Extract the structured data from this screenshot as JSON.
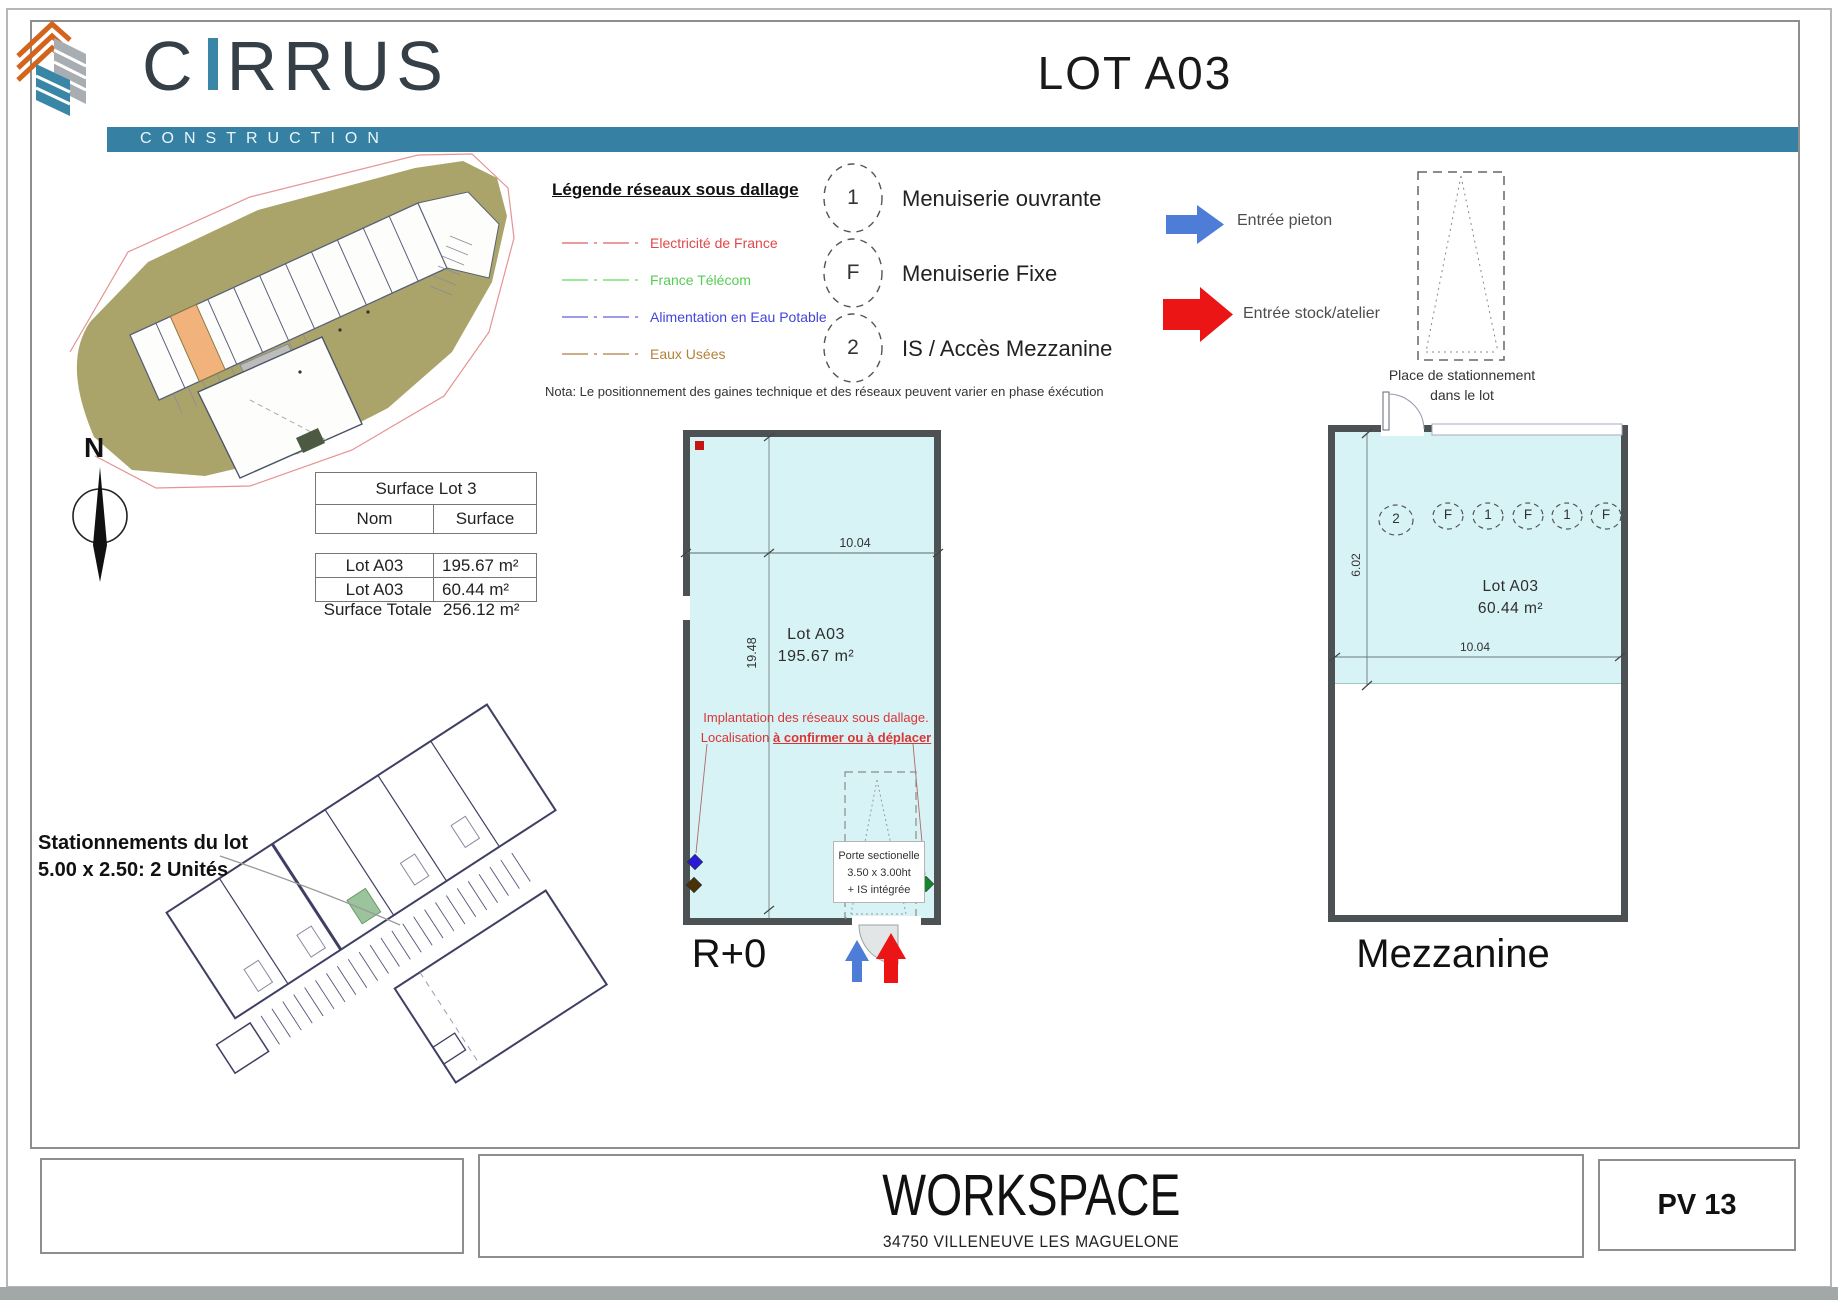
{
  "header": {
    "brand": "CIRRUS",
    "brand_tagline": "CONSTRUCTION",
    "sheet_title": "LOT A03"
  },
  "colors": {
    "brand_teal": "#3580a3",
    "plan_fill": "#d8f3f6",
    "wall_grey": "#4c5254",
    "entry_blue": "#4d7dd6",
    "entry_red": "#ec1515",
    "site_olive": "#aaa46b",
    "highlight_orange": "#f2b27c",
    "warning_red": "#d93535"
  },
  "site_plan": {
    "north_label": "N"
  },
  "legend_networks": {
    "title": "Légende réseaux sous dallage",
    "items": [
      {
        "label": "Electricité de France",
        "color": "#e04848"
      },
      {
        "label": "France Télécom",
        "color": "#55cc55"
      },
      {
        "label": "Alimentation en Eau Potable",
        "color": "#4444dd"
      },
      {
        "label": "Eaux Usées",
        "color": "#b5823c"
      }
    ],
    "nota": "Nota: Le positionnement des gaines technique et des réseaux peuvent varier en phase éxécution"
  },
  "legend_openings": {
    "items": [
      {
        "symbol": "1",
        "label": "Menuiserie ouvrante"
      },
      {
        "symbol": "F",
        "label": "Menuiserie Fixe"
      },
      {
        "symbol": "2",
        "label": "IS / Accès Mezzanine"
      }
    ]
  },
  "legend_entrances": {
    "pedestrian": {
      "label": "Entrée pieton",
      "color": "#4d7dd6"
    },
    "stock": {
      "label": "Entrée stock/atelier",
      "color": "#ec1515"
    }
  },
  "parking_legend": {
    "line1": "Place de stationnement",
    "line2": "dans le lot"
  },
  "surface_table": {
    "title": "Surface Lot 3",
    "col_nom": "Nom",
    "col_surface": "Surface",
    "rows": [
      {
        "nom": "Lot A03",
        "surface": "195.67 m²"
      },
      {
        "nom": "Lot A03",
        "surface": "60.44 m²"
      }
    ],
    "total_label": "Surface Totale",
    "total_value": "256.12 m²"
  },
  "plan_r0": {
    "floor_label": "R+0",
    "lot_name": "Lot A03",
    "lot_area": "195.67 m²",
    "width_dim": "10.04",
    "height_dim": "19.48",
    "network_note_line1": "Implantation des réseaux sous dallage.",
    "network_note_prefix": "Localisation ",
    "network_note_emphasis": "à confirmer ou à déplacer",
    "door_note": [
      "Porte sectionelle",
      "3.50 x 3.00ht",
      "+ IS intégrée"
    ]
  },
  "plan_mezzanine": {
    "floor_label": "Mezzanine",
    "lot_name": "Lot A03",
    "lot_area": "60.44 m²",
    "width_dim": "10.04",
    "height_dim": "6.02",
    "opening_symbols": [
      "2",
      "F",
      "1",
      "F",
      "1",
      "F"
    ]
  },
  "parking_note": {
    "line1": "Stationnements du lot",
    "line2": "5.00 x 2.50: 2 Unités"
  },
  "footer": {
    "project": "WORKSPACE",
    "city": "34750 VILLENEUVE LES MAGUELONE",
    "sheet": "PV 13"
  }
}
